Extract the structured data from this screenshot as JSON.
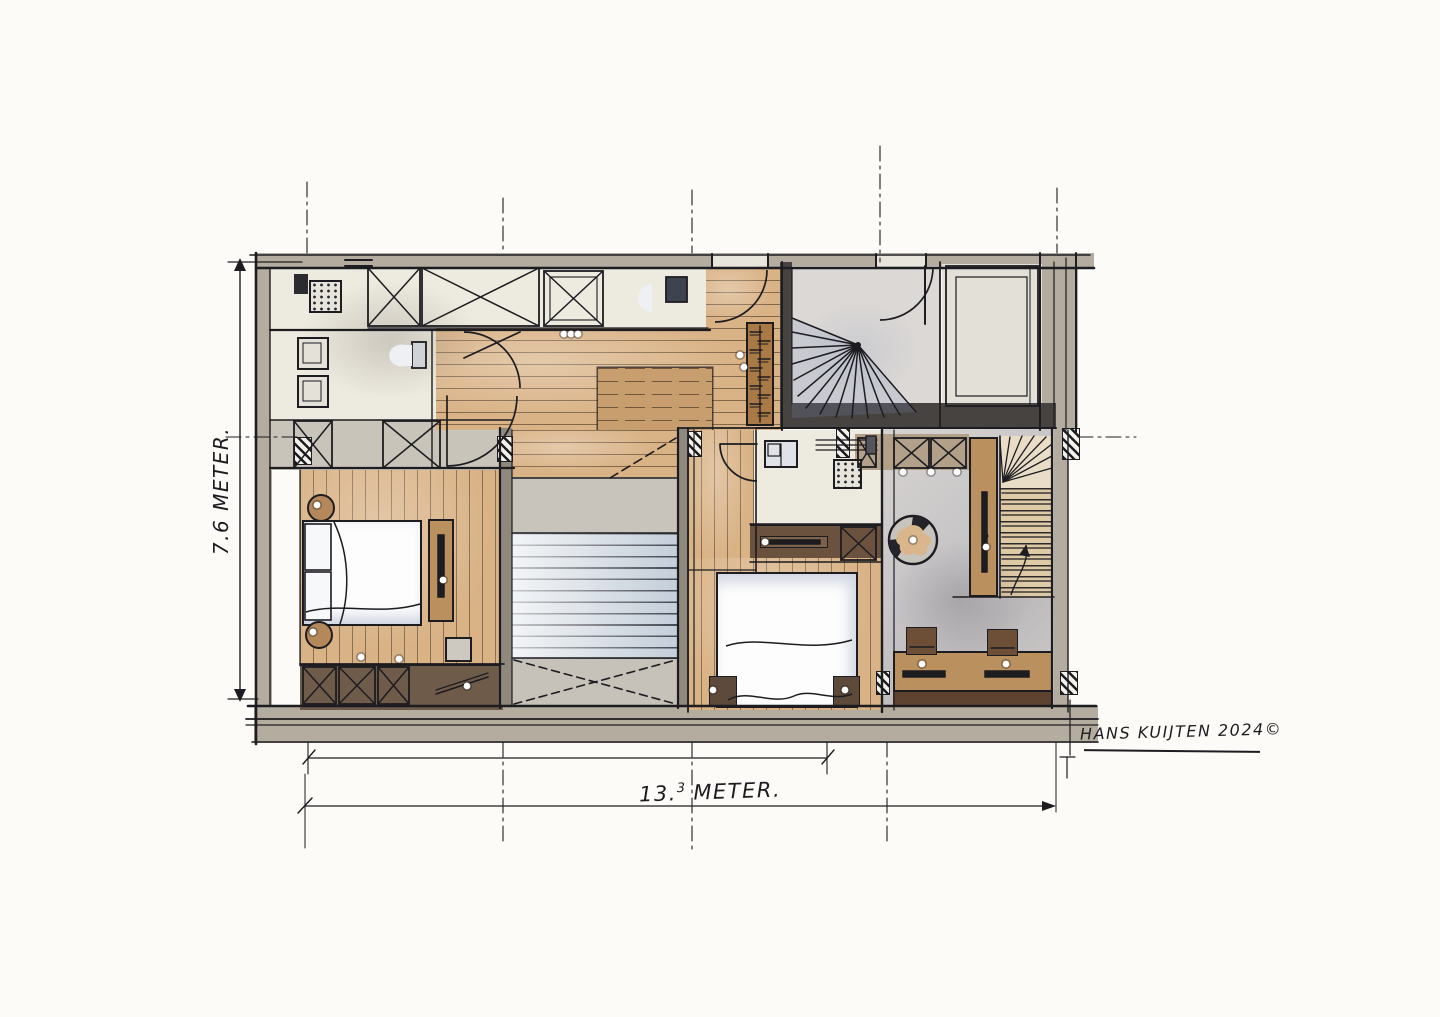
{
  "labels": {
    "height_dimension": "7.6 METER.",
    "width_dimension_whole": "13.",
    "width_dimension_sup": "3",
    "width_dimension_unit": "METER.",
    "signature": "HANS KUIJTEN 2024©"
  },
  "palette": {
    "paper": "#fcfbf7",
    "ink": "#1d1c20",
    "wall": "#b4ac9f",
    "wall-dark": "#474340",
    "cream": "#edeae0",
    "wood": "#d9b285",
    "wood-deep": "#c89e6e",
    "brown-dark": "#6a523f",
    "furniture": "#b9905e",
    "stair-blue": "#ccd5de",
    "gray-floor": "#cfccc9"
  }
}
